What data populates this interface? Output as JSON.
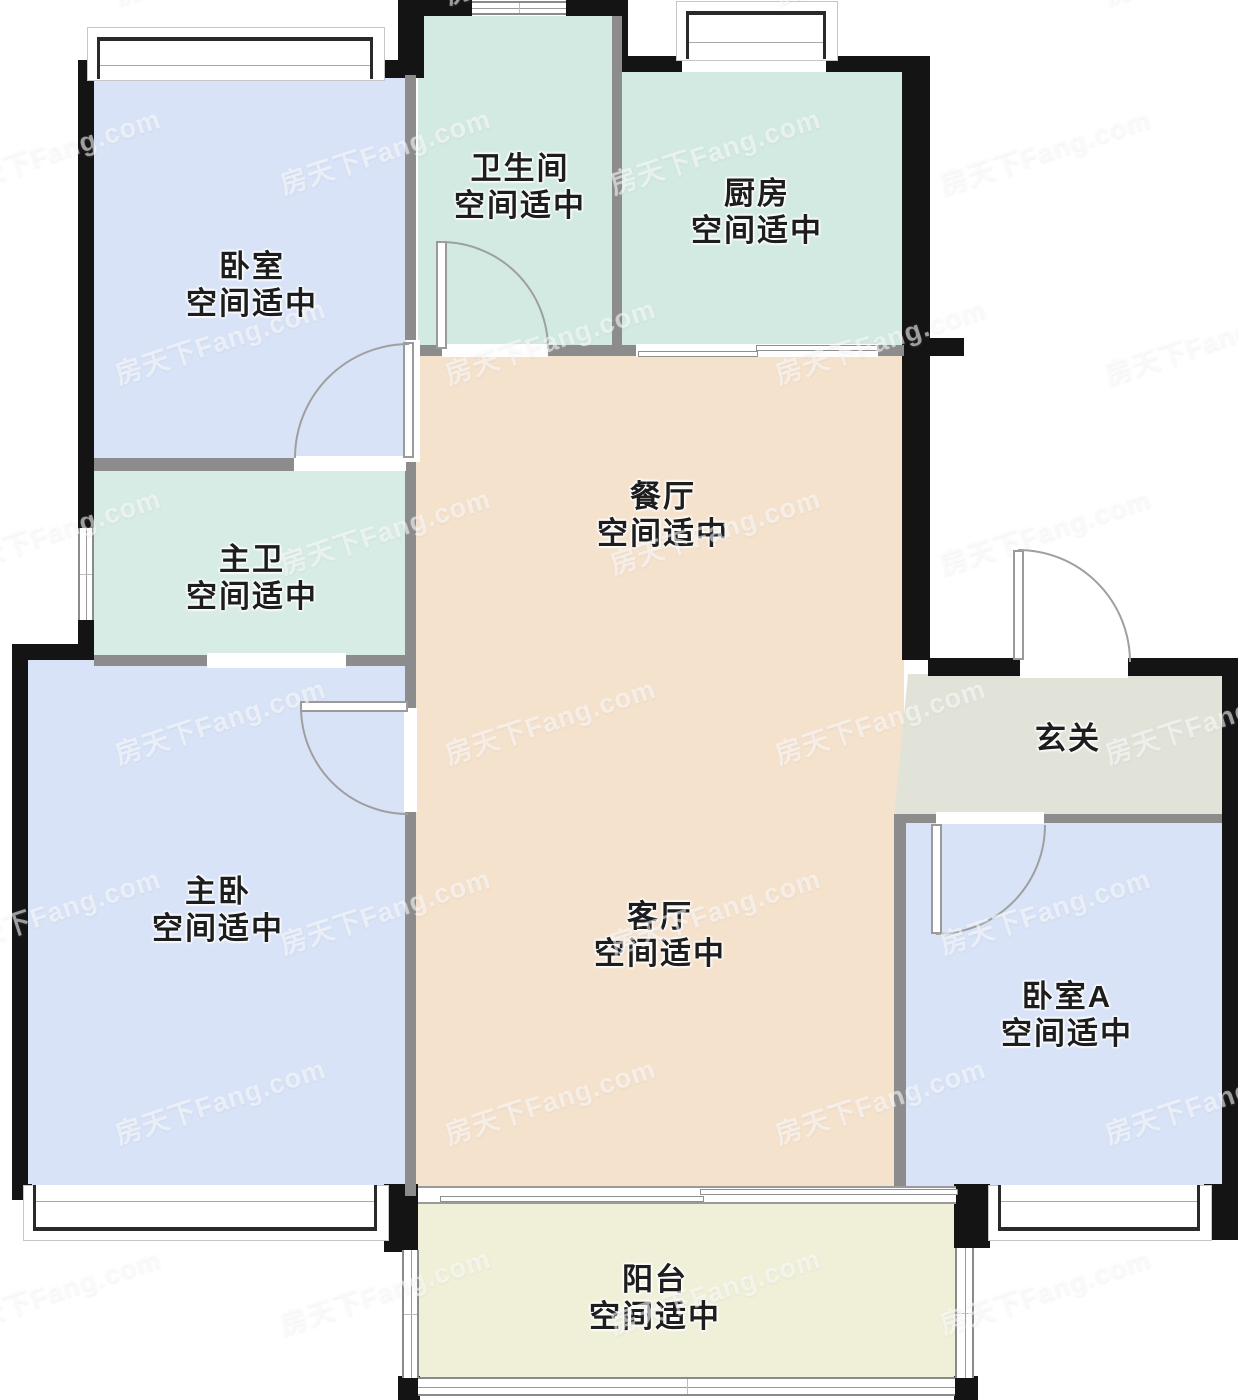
{
  "meta": {
    "title": "户型图",
    "note_common": "空间适中"
  },
  "watermark": {
    "text": "房天下Fang.com"
  },
  "rooms": [
    {
      "id": "bedroom-top",
      "name": "卧室",
      "note": "空间适中"
    },
    {
      "id": "bathroom",
      "name": "卫生间",
      "note": "空间适中"
    },
    {
      "id": "kitchen",
      "name": "厨房",
      "note": "空间适中"
    },
    {
      "id": "dining",
      "name": "餐厅",
      "note": "空间适中"
    },
    {
      "id": "master-bath",
      "name": "主卫",
      "note": "空间适中"
    },
    {
      "id": "master-bedroom",
      "name": "主卧",
      "note": "空间适中"
    },
    {
      "id": "living",
      "name": "客厅",
      "note": "空间适中"
    },
    {
      "id": "entry",
      "name": "玄关",
      "note": ""
    },
    {
      "id": "bedroom-a",
      "name": "卧室A",
      "note": "空间适中"
    },
    {
      "id": "balcony",
      "name": "阳台",
      "note": "空间适中"
    }
  ],
  "colors": {
    "bedroom_floor": "#d8e3f8",
    "wet_room_floor": "#d2eae2",
    "hall_floor": "#f5e2cd",
    "balcony_floor": "#f0f0d9",
    "entry_floor": "#e2e3d8",
    "outer_wall": "#141414",
    "inner_wall": "#8c8c8c",
    "label_text": "#1d1d1d"
  }
}
